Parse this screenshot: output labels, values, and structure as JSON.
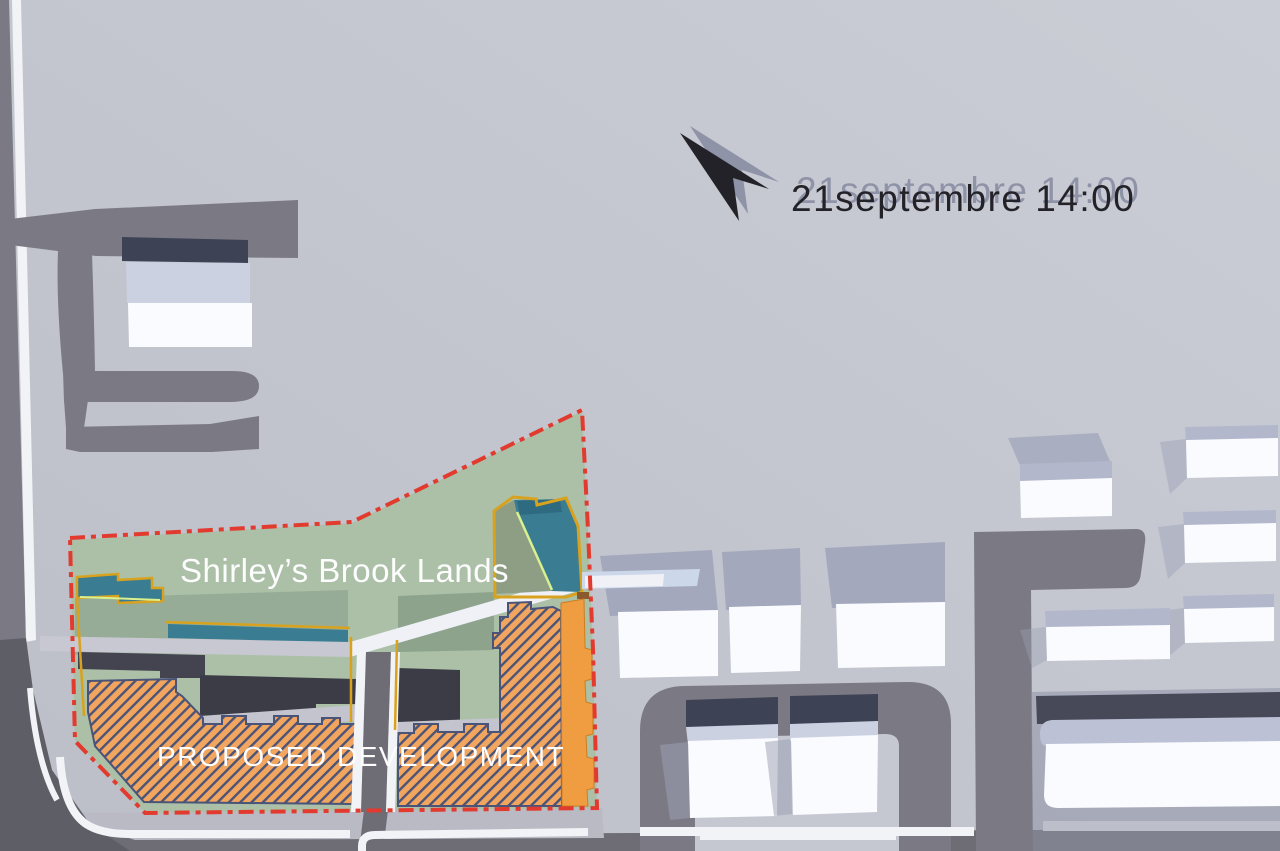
{
  "annotation": {
    "datetime": "21septembre 14:00"
  },
  "labels": {
    "site_area": "Shirley’s Brook Lands",
    "development": "PROPOSED DEVELOPMENT"
  },
  "icons": {
    "north_arrow": "north-arrow"
  },
  "legend_semantics": {
    "red_dashdot_line": "site boundary",
    "orange_hatch": "proposed buildings",
    "teal": "water / brook features",
    "green": "open lands",
    "white_blocks": "existing buildings",
    "dark_gray": "roads"
  },
  "colors": {
    "bg": "#c9cbd4",
    "bg2": "#bdbfc9",
    "road": "#7b7a84",
    "roaddark": "#5e5e66",
    "band": "#6e6d76",
    "curb": "#f2f3f7",
    "pad": "#b9bac4",
    "bldgwhite": "#fafbfe",
    "roofa": "#ccd1e2",
    "roofb": "#b2b7cc",
    "navyband": "#3d4254",
    "castshadow": "#a3a8bd",
    "green1": "#abc0a7",
    "green2": "#96ac96",
    "green3": "#8da38c",
    "sage": "#8e9e85",
    "teal": "#3a7c91",
    "tealdark": "#2f6b80",
    "gold": "#d9a21e",
    "lime": "#d9f08f",
    "orange": "#f2a55e",
    "orangesolid": "#f09c41",
    "orangeedge": "#cd7e21",
    "navyline": "#4a5478",
    "shadow1": "#434450",
    "shadow2": "#3b3c46",
    "red": "#e23a2e",
    "pathwhite": "#eff1f7",
    "pathblue": "#ccd7ea",
    "pathgray": "#c7c8d2",
    "ink": "#232228",
    "inkshadow": "#8f93a8",
    "label": "#fdfdfe"
  }
}
